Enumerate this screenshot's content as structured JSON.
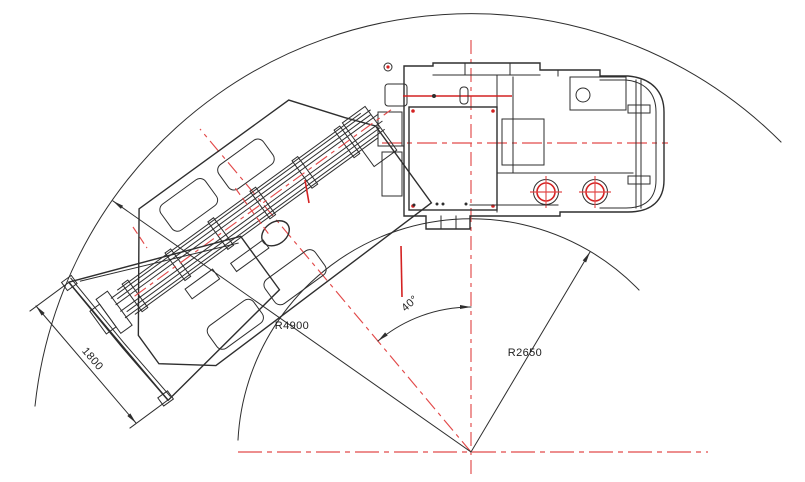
{
  "diagram": {
    "kind": "Articulated vehicle turning-radius CAD drawing (top view)",
    "labels": {
      "blade_width": "1800",
      "outer_radius": "R4900",
      "inner_radius": "R2650",
      "articulation_angle": "40°"
    },
    "colors": {
      "linework": "#2e2e2e",
      "centerline_red": "#e24a4a",
      "detail_red": "#d42222",
      "background": "#ffffff"
    }
  }
}
